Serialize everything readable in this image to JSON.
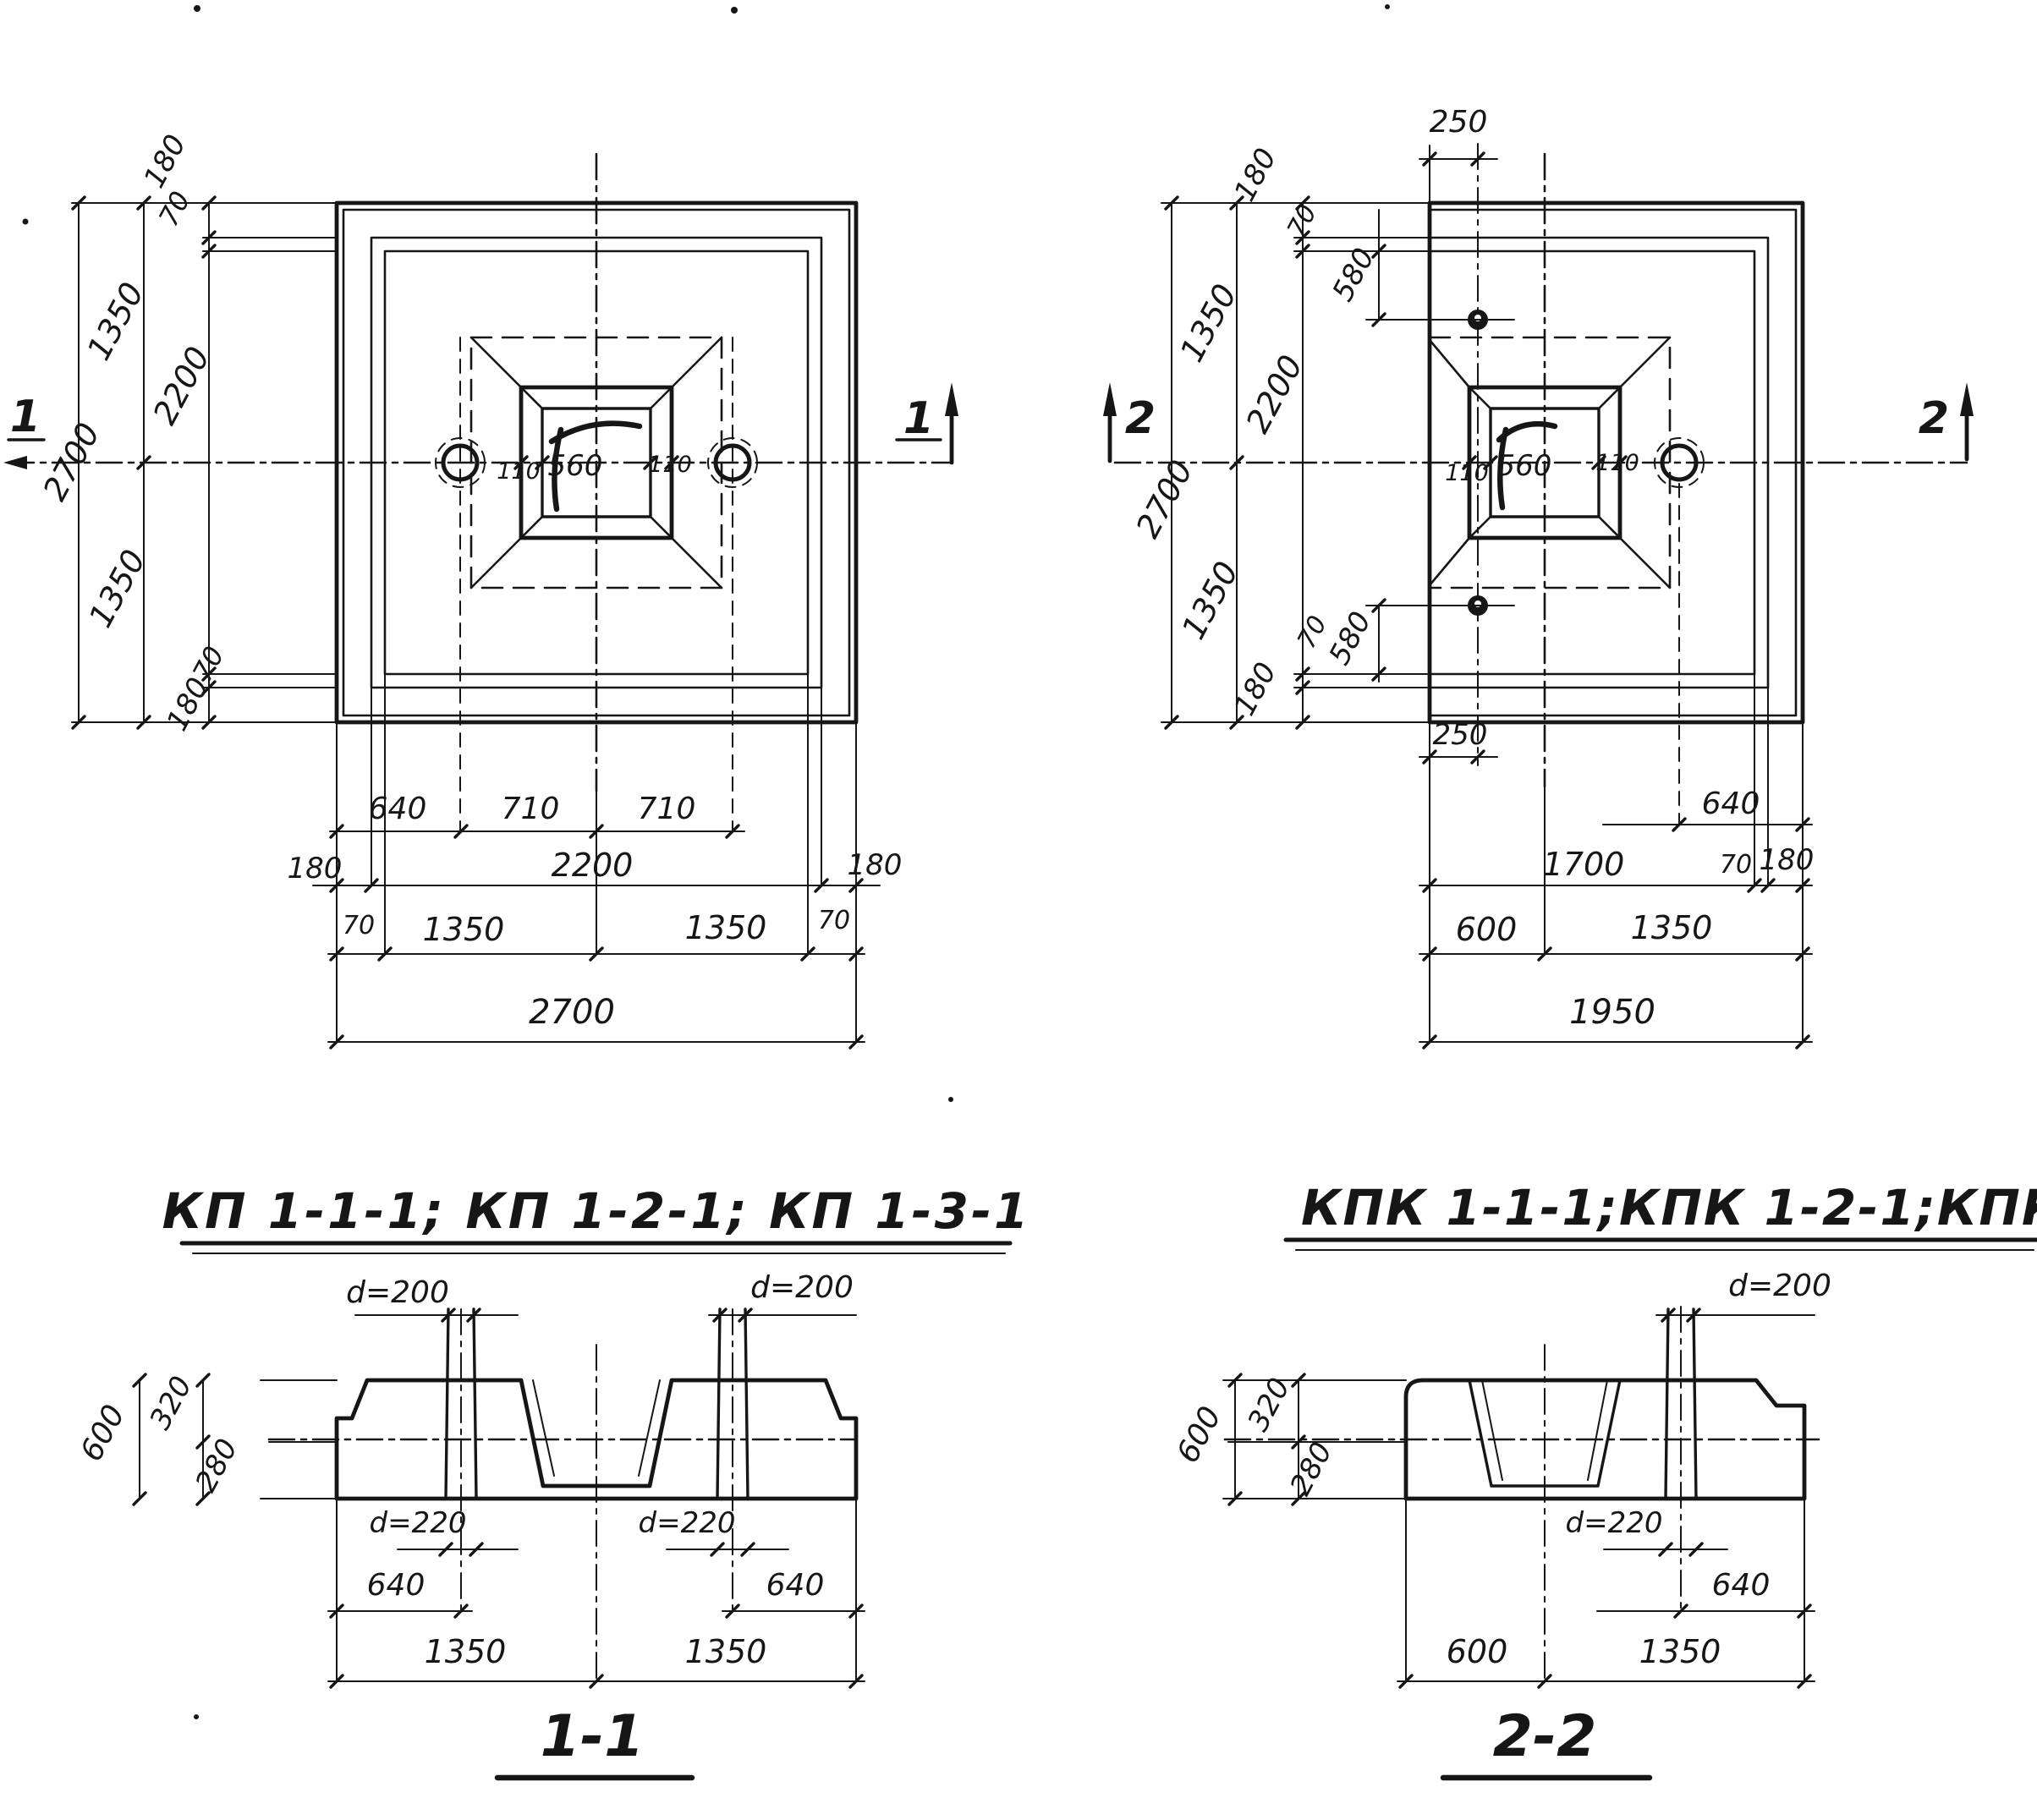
{
  "colors": {
    "paper": "#ffffff",
    "ink": "#161616"
  },
  "plan_kp": {
    "title": "КП 1-1-1; КП 1-2-1; КП 1-3-1",
    "marker": "1",
    "v180t": "180",
    "v70t": "70",
    "v1350t": "1350",
    "v2700": "2700",
    "v2200": "2200",
    "v1350b": "1350",
    "v70b": "70",
    "v180b": "180",
    "c110l": "110",
    "c560": "560",
    "c110r": "110",
    "r1_640": "640",
    "r1_710a": "710",
    "r1_710b": "710",
    "r2_180l": "180",
    "r2_2200": "2200",
    "r2_180r": "180",
    "r3_70l": "70",
    "r3_1350l": "1350",
    "r3_1350r": "1350",
    "r3_70r": "70",
    "r4_2700": "2700"
  },
  "plan_kpk": {
    "title": "КПК 1-1-1;КПК 1-2-1;КПК 1-3-1",
    "marker": "2",
    "t250": "250",
    "t180": "180",
    "t70": "70",
    "t580": "580",
    "v1350t": "1350",
    "v2700": "2700",
    "v2200": "2200",
    "v1350b": "1350",
    "v180b": "180",
    "b70": "70",
    "b580": "580",
    "b250": "250",
    "c110l": "110",
    "c560": "560",
    "c110r": "110",
    "r1_640": "640",
    "r2_1700": "1700",
    "r2_70": "70",
    "r2_180": "180",
    "r3_600": "600",
    "r3_1350": "1350",
    "r4_1950": "1950"
  },
  "sec11": {
    "title": "1-1",
    "d200l": "d=200",
    "d200r": "d=200",
    "h600": "600",
    "h320": "320",
    "h280": "280",
    "d220l": "d=220",
    "d220r": "d=220",
    "b640l": "640",
    "b640r": "640",
    "b1350l": "1350",
    "b1350r": "1350"
  },
  "sec22": {
    "title": "2-2",
    "d200": "d=200",
    "h600": "600",
    "h320": "320",
    "h280": "280",
    "d220": "d=220",
    "b640": "640",
    "b600": "600",
    "b1350": "1350"
  }
}
